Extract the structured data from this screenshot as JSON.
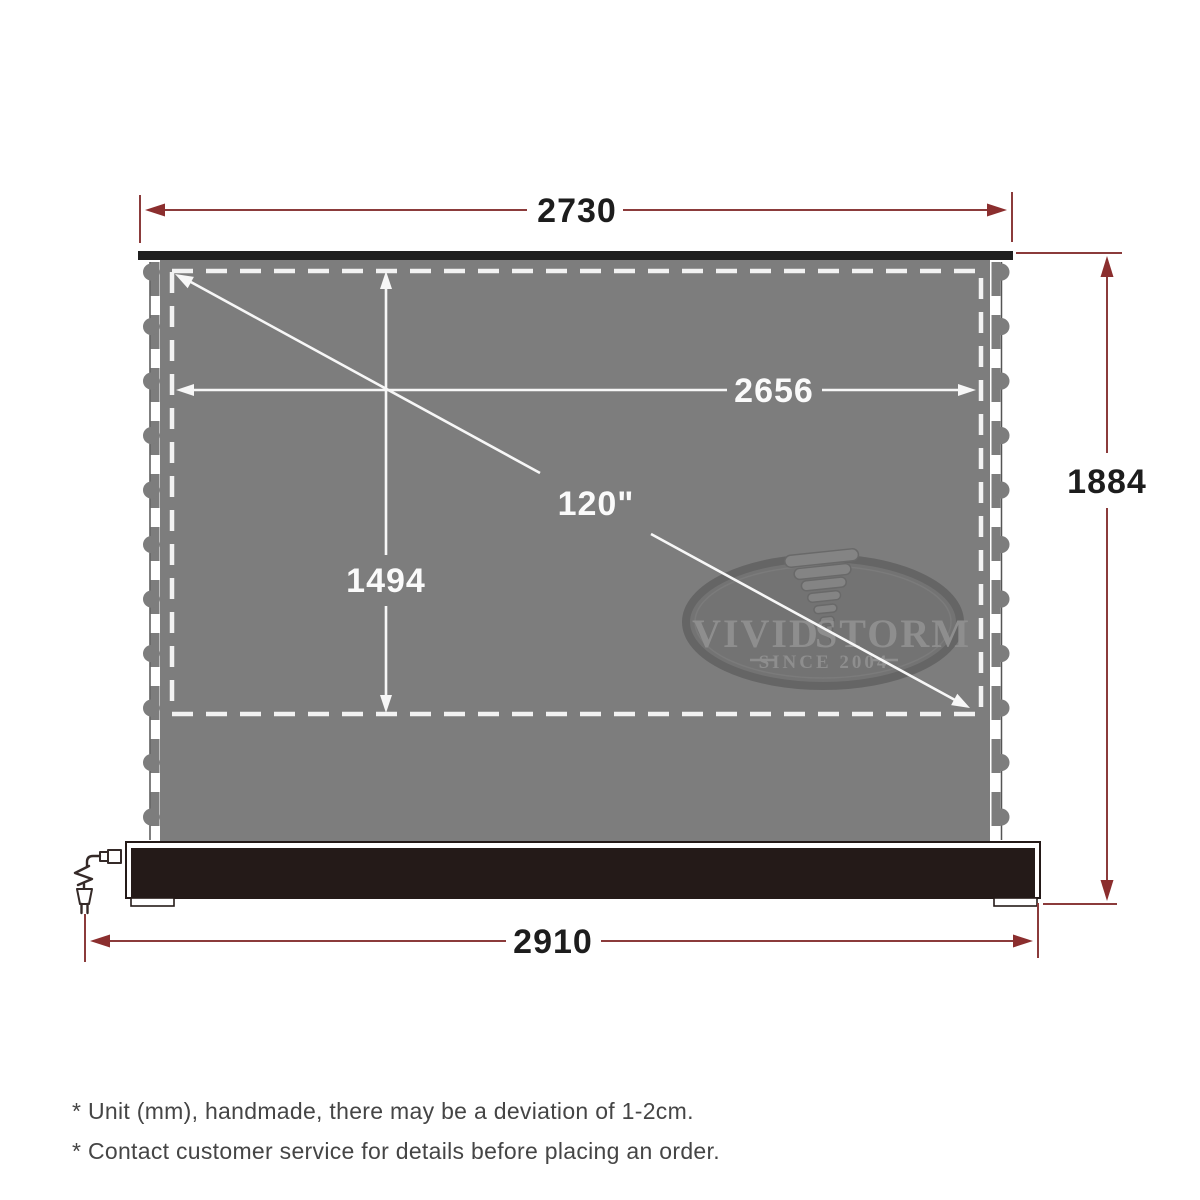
{
  "diagram": {
    "title": "projector-screen-dimension-diagram",
    "dimensions": {
      "top_width": "2730",
      "inner_width": "2656",
      "diagonal": "120\"",
      "inner_height": "1494",
      "total_height": "1884",
      "base_width": "2910"
    },
    "dimension_values_mm": {
      "top_width": 2730,
      "inner_width": 2656,
      "inner_height": 1494,
      "total_height": 1884,
      "base_width": 2910,
      "diagonal_inches": 120
    },
    "logo": {
      "word_left": "VIVID",
      "word_right": "STORM",
      "tagline": "SINCE 2004"
    },
    "footnotes": [
      "* Unit (mm), handmade, there may be a deviation of 1-2cm.",
      "* Contact customer service for details before placing an order."
    ],
    "colors": {
      "dimension_red_line": "#8b3b3b",
      "dimension_red_arrow": "#8b2e2e",
      "screen_gray": "#7d7d7d",
      "top_slat_black": "#1f1f1f",
      "base_housing_black": "#241a18",
      "inner_marking_white": "#f7f7f7",
      "logo_gray": "#8e8e8e",
      "footnote_gray": "#454545"
    }
  }
}
